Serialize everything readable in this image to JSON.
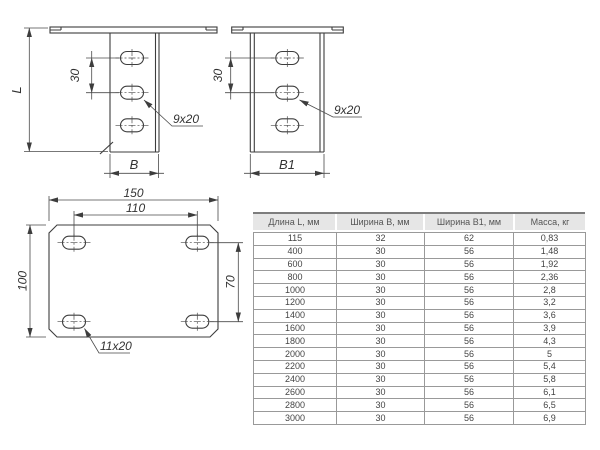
{
  "drawings": {
    "front_view": {
      "length_label": "L",
      "hole_spacing_label": "30",
      "hole_size_label": "9x20",
      "width_label": "B"
    },
    "side_view": {
      "hole_spacing_label": "30",
      "hole_size_label": "9x20",
      "width_label": "B1"
    },
    "plan_view": {
      "overall_width_label": "150",
      "hole_pitch_x_label": "110",
      "overall_height_label": "100",
      "hole_pitch_y_label": "70",
      "hole_size_label": "11x20"
    }
  },
  "table": {
    "headers": [
      "Длина L, мм",
      "Ширина B, мм",
      "Ширина B1, мм",
      "Масса, кг"
    ],
    "rows": [
      [
        "115",
        "32",
        "62",
        "0,83"
      ],
      [
        "400",
        "30",
        "56",
        "1,48"
      ],
      [
        "600",
        "30",
        "56",
        "1,92"
      ],
      [
        "800",
        "30",
        "56",
        "2,36"
      ],
      [
        "1000",
        "30",
        "56",
        "2,8"
      ],
      [
        "1200",
        "30",
        "56",
        "3,2"
      ],
      [
        "1400",
        "30",
        "56",
        "3,6"
      ],
      [
        "1600",
        "30",
        "56",
        "3,9"
      ],
      [
        "1800",
        "30",
        "56",
        "4,3"
      ],
      [
        "2000",
        "30",
        "56",
        "5"
      ],
      [
        "2200",
        "30",
        "56",
        "5,4"
      ],
      [
        "2400",
        "30",
        "56",
        "5,8"
      ],
      [
        "2600",
        "30",
        "56",
        "6,1"
      ],
      [
        "2800",
        "30",
        "56",
        "6,5"
      ],
      [
        "3000",
        "30",
        "56",
        "6,9"
      ]
    ]
  },
  "colors": {
    "line": "#3d3d3d",
    "header_bg": "#e6e6e6",
    "table_border": "#999999",
    "text": "#444444"
  }
}
